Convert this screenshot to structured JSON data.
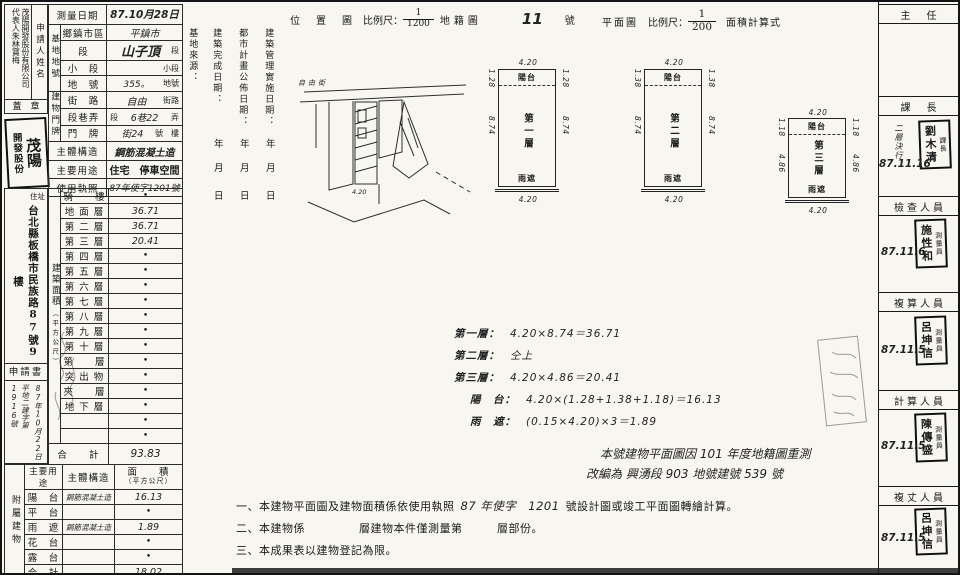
{
  "applicant": {
    "label": "申請人姓名",
    "name": "茂陽開發股份有限公司　代表人朱林寶梅",
    "seal_label": "蓋　章",
    "seal_large": "茂陽",
    "seal_small": "開發股份",
    "address_label": "住址",
    "address": "台北縣板橋市民族路87號9樓",
    "application_doc": "申請書",
    "receipt_date": "87年10月22日",
    "receipt_number": "平地二建字第1916號"
  },
  "info": {
    "survey_date_label": "測量日期",
    "survey_date_value": "87.10月28日",
    "site_group": "基地地號",
    "site_rows": [
      {
        "label": "鄉鎮市區",
        "prefix": "",
        "value": "平鎮市",
        "suffix": ""
      },
      {
        "label": "段",
        "prefix": "",
        "value": "山子頂",
        "suffix": "段"
      },
      {
        "label": "小　段",
        "prefix": "",
        "value": "",
        "suffix": "小段"
      },
      {
        "label": "地　號",
        "prefix": "",
        "value": "355。",
        "suffix": "地號"
      }
    ],
    "door_group": "建物門牌",
    "door_rows": [
      {
        "label": "街　路",
        "prefix": "",
        "value": "自由",
        "suffix": "街路"
      },
      {
        "label": "段巷弄",
        "prefix": "段",
        "value": "6巷22",
        "suffix": "弄"
      },
      {
        "label": "門　牌",
        "prefix": "",
        "value": "街24",
        "suffix": "號　樓"
      }
    ],
    "structure_label": "主體構造",
    "structure_value": "鋼筋混凝土造",
    "usage_label": "主要用途",
    "usage_value": "住宅　停車空間",
    "license_label": "使用執照",
    "license_value": "87年使字1201號"
  },
  "area": {
    "group_main": "建築面積",
    "group_sub": "（平方公尺）",
    "rows": [
      {
        "label": "騎　　樓",
        "value": "•"
      },
      {
        "label": "地 面 層",
        "value": "36.71"
      },
      {
        "label": "第 二 層",
        "value": "36.71"
      },
      {
        "label": "第 三 層",
        "value": "20.41"
      },
      {
        "label": "第 四 層",
        "value": "•"
      },
      {
        "label": "第 五 層",
        "value": "•"
      },
      {
        "label": "第 六 層",
        "value": "•"
      },
      {
        "label": "第 七 層",
        "value": "•"
      },
      {
        "label": "第 八 層",
        "value": "•"
      },
      {
        "label": "第 九 層",
        "value": "•"
      },
      {
        "label": "第 十 層",
        "value": "•"
      },
      {
        "label": "第　　層",
        "value": "•"
      },
      {
        "label": "突 出 物",
        "value": "•"
      },
      {
        "label": "夾　　層",
        "value": "•"
      },
      {
        "label": "地 下 層",
        "value": "•"
      },
      {
        "label": "",
        "value": "•"
      },
      {
        "label": "",
        "value": "•"
      }
    ],
    "total_label": "合　　計",
    "total_value": "93.83"
  },
  "annex": {
    "group": "附屬建物",
    "col_usage": "主要用途",
    "col_structure": "主體構造",
    "col_area_1": "面　　積",
    "col_area_2": "（平方公尺）",
    "rows": [
      {
        "usage": "陽　台",
        "structure": "鋼筋混凝土造",
        "area": "16.13"
      },
      {
        "usage": "平　台",
        "structure": "",
        "area": "•"
      },
      {
        "usage": "雨　遮",
        "structure": "鋼筋混凝土造",
        "area": "1.89"
      },
      {
        "usage": "花　台",
        "structure": "",
        "area": "•"
      },
      {
        "usage": "露　台",
        "structure": "",
        "area": "•"
      },
      {
        "usage": "合　計",
        "structure": "",
        "area": "18.02"
      }
    ]
  },
  "middle": {
    "source_label": "基地來源：",
    "col1": "建築完成日期：",
    "col2": "都市計畫公佈日期：",
    "col3": "建築管理實施日期：",
    "year": "年",
    "month": "月",
    "day": "日"
  },
  "headers": {
    "location_title": "位　置　圖",
    "scale_label": "比例尺：",
    "location_num": "1",
    "location_den": "1200",
    "cadastral_label": "地籍圖",
    "sheet_no": "11",
    "sheet_no_suffix": "號",
    "plan_title": "平面圖",
    "plan_num": "1",
    "plan_den": "200",
    "calc_label": "面積計算式"
  },
  "map": {
    "road_label": "自由街",
    "building_dim": "4.20"
  },
  "plans": [
    {
      "balcony": "陽台",
      "name": "第一層",
      "eave": "雨遮",
      "width": "4.20",
      "balcony_depth": "1.28",
      "body_depth": "8.74"
    },
    {
      "balcony": "陽台",
      "name": "第二層",
      "eave": "雨遮",
      "width": "4.20",
      "balcony_depth": "1.38",
      "body_depth": "8.74"
    },
    {
      "balcony": "陽台",
      "name": "第三層",
      "eave": "雨遮",
      "width": "4.20",
      "balcony_depth": "1.18",
      "body_depth": "4.86"
    }
  ],
  "calc": {
    "lines": [
      {
        "label": "第一層：",
        "expr": "4.20×8.74＝36.71"
      },
      {
        "label": "第二層：",
        "expr": "仝上"
      },
      {
        "label": "第三層：",
        "expr": "4.20×4.86＝20.41"
      },
      {
        "label": "陽　台：",
        "expr": "4.20×(1.28+1.38+1.18)＝16.13"
      },
      {
        "label": "雨　遮：",
        "expr": "(0.15×4.20)×3＝1.89"
      }
    ]
  },
  "remark": {
    "line1": "本號建物平面圖因 101 年度地籍圖重測",
    "line2": "改編為 興湧段 903 地號建號 539 號"
  },
  "notes": [
    {
      "no": "一、",
      "pre": "本建物平面圖及建物面積係依使用執照",
      "hw": "87 年使字　1201",
      "post": "號設計圖或竣工平面圖轉繪計算。"
    },
    {
      "no": "二、",
      "pre": "本建物係",
      "hw": "",
      "post": "層建物本件僅測量第　　　層部份。"
    },
    {
      "no": "三、",
      "pre": "本成果表以建物登記為限。",
      "hw": "",
      "post": ""
    }
  ],
  "officials": {
    "sections": [
      {
        "title": "主　任"
      },
      {
        "title": "課　長",
        "stamp_prefix": "課長",
        "stamp_name": "劉木清",
        "note": "二層決行",
        "date": "87.11.16"
      },
      {
        "title": "檢查人員",
        "stamp_prefix": "測量員",
        "stamp_name": "施性和",
        "date": "87.11.6"
      },
      {
        "title": "複算人員",
        "stamp_prefix": "測量員",
        "stamp_name": "呂坤信",
        "date": "87.11.5"
      },
      {
        "title": "計算人員",
        "stamp_prefix": "測量員",
        "stamp_name": "陳傳盛",
        "date": "87.11.5"
      },
      {
        "title": "複丈人員",
        "stamp_prefix": "測量員",
        "stamp_name": "呂坤信",
        "date": "87.11.5"
      }
    ]
  }
}
